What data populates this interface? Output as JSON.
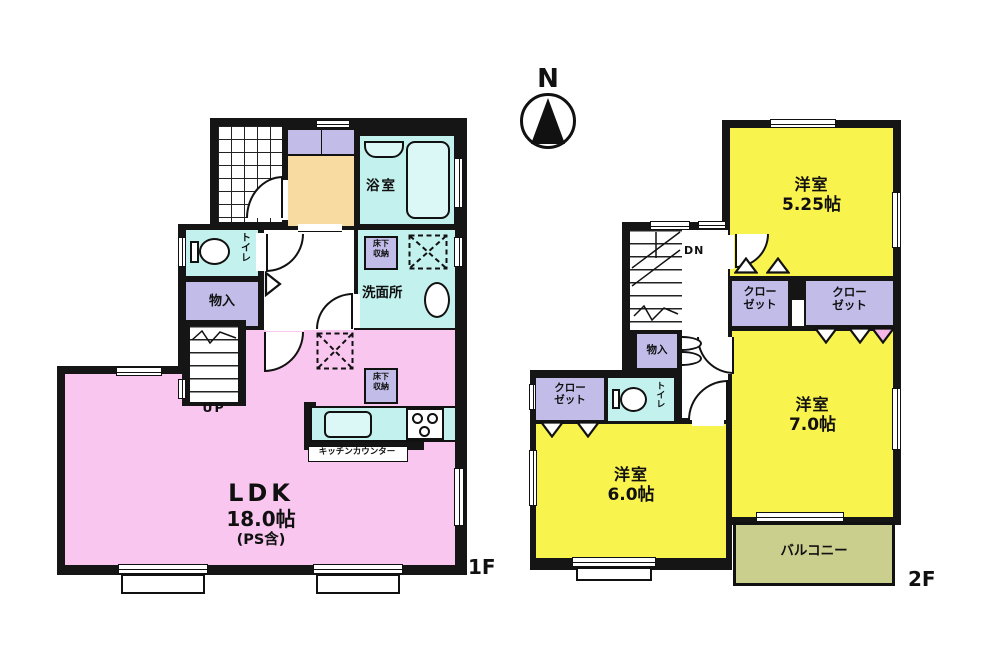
{
  "compass": {
    "north_label": "N"
  },
  "colors": {
    "wall": "#151515",
    "pink": "#f8c6ee",
    "yellow": "#f9f34e",
    "purple": "#c1bce8",
    "cyan": "#c3f1ee",
    "cream": "#f7dba1",
    "olive": "#cbcf8e",
    "fixture": "#dbf8f6"
  },
  "floor1": {
    "floor_label": "1F",
    "stairs_label": "UP",
    "bathroom_label": "浴室",
    "toilet_label": "トイレ",
    "storage_label": "物入",
    "washroom_label": "洗面所",
    "underfloor_storage_label": "床下収納",
    "underfloor_storage_label_2": "床下収納",
    "kitchen_counter_label": "キッチンカウンター",
    "ldk_name": "LDK",
    "ldk_size": "18.0帖",
    "ldk_note": "(PS含)"
  },
  "floor2": {
    "floor_label": "2F",
    "stairs_label": "DN",
    "bedroom_a_name": "洋室",
    "bedroom_a_size": "5.25帖",
    "bedroom_b_name": "洋室",
    "bedroom_b_size": "7.0帖",
    "bedroom_c_name": "洋室",
    "bedroom_c_size": "6.0帖",
    "closet_a_label": "クローゼット",
    "closet_b_label": "クローゼット",
    "closet_c_label": "クローゼット",
    "storage_label": "物入",
    "toilet_label": "トイレ",
    "balcony_label": "バルコニー"
  }
}
